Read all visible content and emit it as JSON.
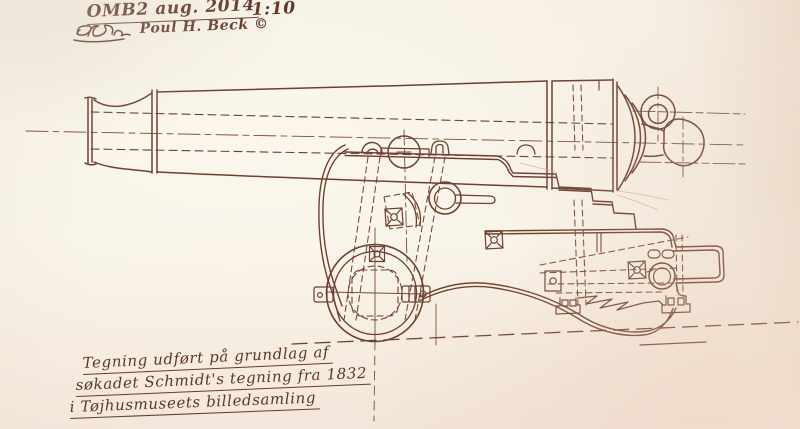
{
  "meta": {
    "kind": "scanned hand-drawn technical drawing",
    "subject": "naval cannon on wooden gun carriage, side elevation"
  },
  "header": {
    "title": "OMB2 aug. 2014",
    "scale_ratio": "1:10",
    "monogram": "PB",
    "credit": "Poul H. Beck ©"
  },
  "footnote": {
    "line1": "Tegning udført på grundlag af",
    "line2": "søkadet Schmidt's tegning fra 1832",
    "line3": "i Tøjhusmuseets billedsamling"
  },
  "drawing": {
    "parts": [
      "muzzle-swell",
      "barrel",
      "bore-hidden-lines",
      "reinforce-ring",
      "breech",
      "cascabel-mouldings",
      "breeching-ring",
      "cascabel-button",
      "carriage-bracket",
      "trunnion",
      "cap-square-bolts",
      "quoin-steps",
      "ring-bolts",
      "bolt-plates",
      "front-truck-wheel",
      "axletree-stubs",
      "rear-handle-bracket",
      "zigzag-break",
      "ground-line",
      "center-lines"
    ]
  },
  "colors": {
    "paper": "#f6efe2",
    "paper_warm": "#f2e3d6",
    "ink": "#6d4030",
    "ink_light": "#8a5843",
    "pencil_faint": "#c7a98d",
    "text_ink": "#5d3728"
  }
}
